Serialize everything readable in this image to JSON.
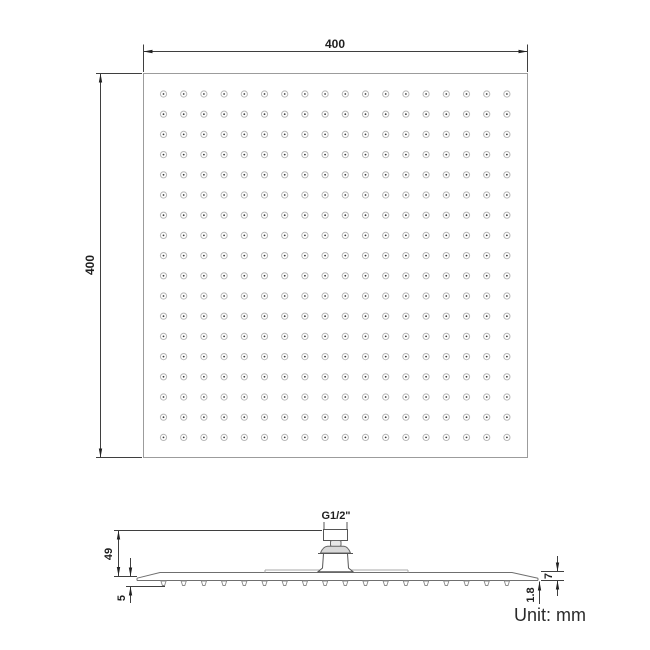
{
  "unit_label": "Unit: mm",
  "colors": {
    "dim_line": "#3f3f3f",
    "outline": "#9c9c9c",
    "profile": "#6f6f6f",
    "nozzle_ring": "#b7b7b7",
    "nozzle_dot": "#3c3c3c",
    "connector_fill": "#d9d9d9"
  },
  "top_view": {
    "width_label": "400",
    "height_label": "400",
    "nozzle_grid": {
      "rows": 18,
      "cols": 18
    }
  },
  "side_view": {
    "thread_label": "G1/2\"",
    "connector_height_label": "49",
    "left_edge_label": "5",
    "right_edge_label": "7",
    "panel_thickness_label": "1.8",
    "nozzle_count": 18
  }
}
